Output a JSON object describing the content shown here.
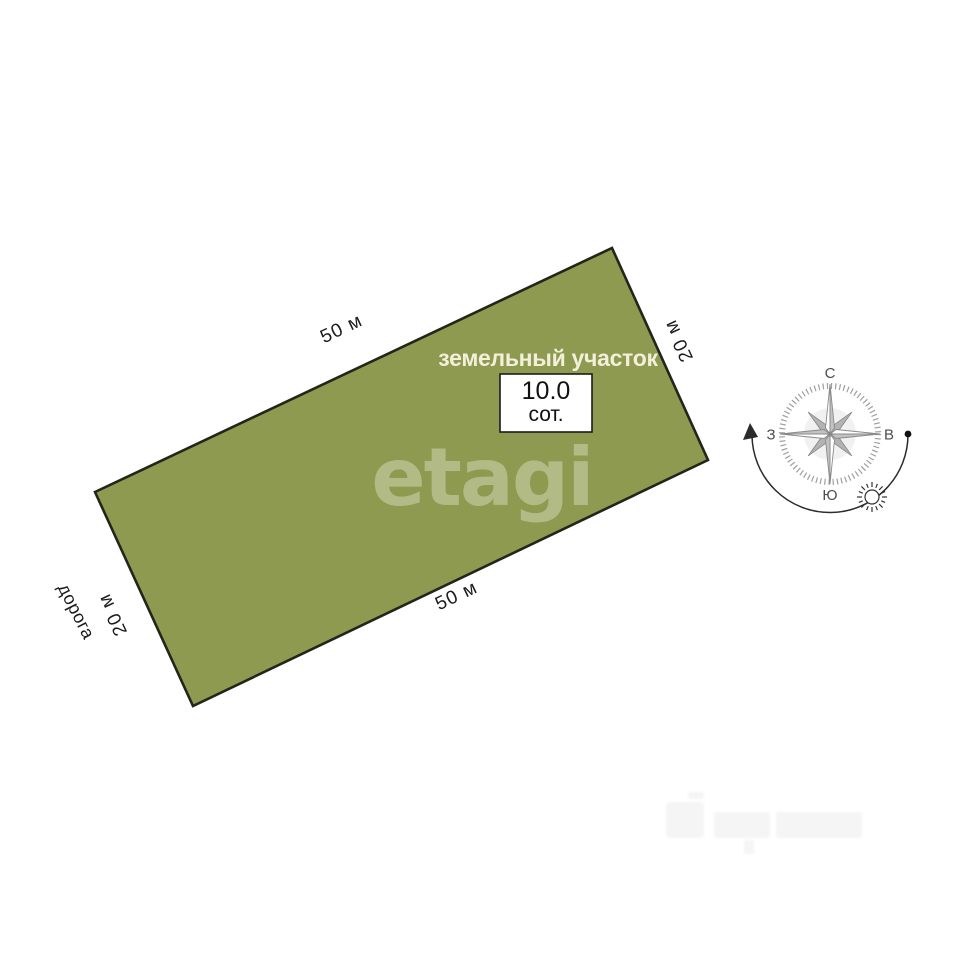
{
  "plot": {
    "title": "земельный участок",
    "area_value": "10.0",
    "area_unit": "сот.",
    "dimensions": {
      "top": "50 м",
      "bottom": "50 м",
      "left": "20 м",
      "right": "20 м"
    },
    "road_label": "дорога"
  },
  "compass": {
    "north": "С",
    "east": "В",
    "west": "З",
    "south": "Ю"
  },
  "watermark": {
    "text": "etagi"
  },
  "colors": {
    "plot_fill": "#8e9a4f",
    "plot_border": "#22261a",
    "background": "#ffffff",
    "dimension_text": "#1c1c1c",
    "plot_title_text": "#f2efda",
    "compass_gray": "#b3b3b3"
  }
}
